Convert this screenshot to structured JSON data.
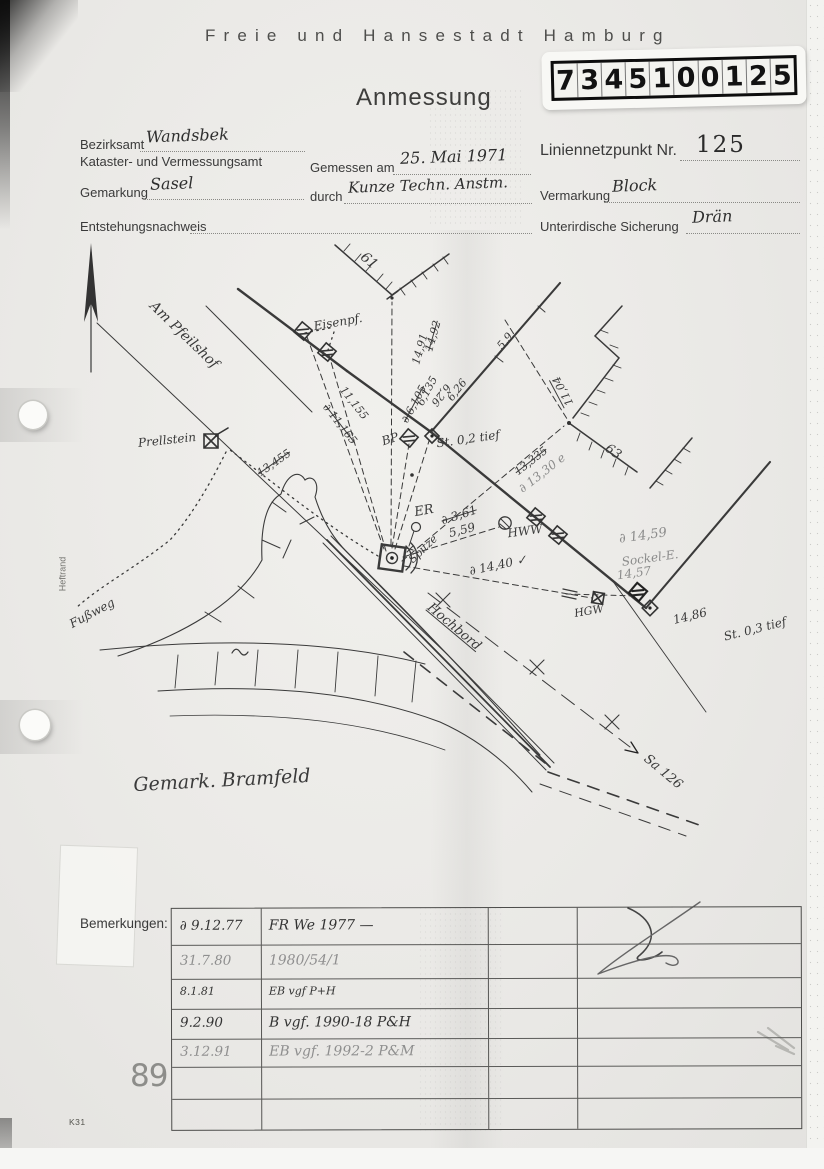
{
  "colors": {
    "paper": "#e9e8e5",
    "ink": "#333333",
    "pencil": "#8b8b8b"
  },
  "header": {
    "title": "Freie und Hansestadt Hamburg",
    "form_title": "Anmessung"
  },
  "id_label": {
    "digits": [
      "7",
      "3",
      "4",
      "5",
      "1",
      "0",
      "0",
      "1",
      "2",
      "5"
    ]
  },
  "form": {
    "bezirksamt_label": "Bezirksamt",
    "bezirksamt_value": "Wandsbek",
    "amt_label": "Kataster- und Vermessungsamt",
    "gemessen_label": "Gemessen am",
    "gemessen_value": "25. Mai 1971",
    "durch_label": "durch",
    "durch_value": "Kunze Techn. Anstm.",
    "punkt_label": "Liniennetzpunkt Nr.",
    "punkt_value": "125",
    "gemarkung_label": "Gemarkung",
    "gemarkung_value": "Sasel",
    "vermarkung_label": "Vermarkung",
    "vermarkung_value": "Block",
    "entstehung_label": "Entstehungsnachweis",
    "sicherung_label": "Unterirdische Sicherung",
    "sicherung_value": "Drän"
  },
  "sketch": {
    "labels": [
      {
        "t": "61",
        "x": 369,
        "y": 261,
        "r": 40,
        "s": 14
      },
      {
        "t": "Eisenpf.",
        "x": 338,
        "y": 322,
        "r": -10,
        "s": 12
      },
      {
        "t": "14,92",
        "x": 433,
        "y": 336,
        "r": -74,
        "s": 11,
        "c": "strike"
      },
      {
        "t": "14,91",
        "x": 420,
        "y": 349,
        "r": -74,
        "s": 11
      },
      {
        "t": "∂ 11,165",
        "x": 340,
        "y": 424,
        "r": 52,
        "s": 11,
        "c": "strike"
      },
      {
        "t": "11,155",
        "x": 354,
        "y": 403,
        "r": 52,
        "s": 11
      },
      {
        "t": "∂ 6,105",
        "x": 414,
        "y": 404,
        "r": -62,
        "s": 11,
        "c": "strike"
      },
      {
        "t": "6,135",
        "x": 427,
        "y": 391,
        "r": -62,
        "s": 11
      },
      {
        "t": "6,26",
        "x": 457,
        "y": 390,
        "r": -52,
        "s": 11
      },
      {
        "t": "6,26",
        "x": 441,
        "y": 395,
        "r": 128,
        "s": 11
      },
      {
        "t": "5,9",
        "x": 505,
        "y": 341,
        "r": -50,
        "s": 11
      },
      {
        "t": "11,04",
        "x": 563,
        "y": 391,
        "r": -118,
        "s": 11,
        "c": "over"
      },
      {
        "t": "63",
        "x": 613,
        "y": 452,
        "r": 35,
        "s": 13
      },
      {
        "t": "St. 0,2 tief",
        "x": 468,
        "y": 439,
        "r": -8,
        "s": 12
      },
      {
        "t": "BP",
        "x": 390,
        "y": 439,
        "r": -18,
        "s": 12
      },
      {
        "t": "13,335",
        "x": 531,
        "y": 461,
        "r": -38,
        "s": 11,
        "c": "strike"
      },
      {
        "t": "∂ 13,30 e",
        "x": 542,
        "y": 473,
        "r": -38,
        "s": 12,
        "c": "pencil"
      },
      {
        "t": "ER",
        "x": 424,
        "y": 511,
        "r": -10,
        "s": 13
      },
      {
        "t": "∂ 3,61",
        "x": 459,
        "y": 515,
        "r": -18,
        "s": 12,
        "c": "strike"
      },
      {
        "t": "5,59",
        "x": 462,
        "y": 530,
        "r": -14,
        "s": 12
      },
      {
        "t": "Spitze",
        "x": 423,
        "y": 549,
        "r": -44,
        "s": 11
      },
      {
        "t": "HWW",
        "x": 525,
        "y": 531,
        "r": -8,
        "s": 12
      },
      {
        "t": "∂ 14,40 ✓",
        "x": 498,
        "y": 565,
        "r": -12,
        "s": 12
      },
      {
        "t": "∂ 14,59",
        "x": 643,
        "y": 536,
        "r": -8,
        "s": 13,
        "c": "pencil"
      },
      {
        "t": "Sockel-E.",
        "x": 650,
        "y": 558,
        "r": -8,
        "s": 12,
        "c": "pencil"
      },
      {
        "t": "14,57",
        "x": 634,
        "y": 573,
        "r": -8,
        "s": 12,
        "c": "pencil"
      },
      {
        "t": "HGW",
        "x": 589,
        "y": 611,
        "r": -10,
        "s": 11
      },
      {
        "t": "14,86",
        "x": 690,
        "y": 616,
        "r": -14,
        "s": 12
      },
      {
        "t": "St. 0,3 tief",
        "x": 755,
        "y": 629,
        "r": -14,
        "s": 12
      },
      {
        "t": "Prellstein",
        "x": 167,
        "y": 440,
        "r": -6,
        "s": 12
      },
      {
        "t": "13,455",
        "x": 274,
        "y": 463,
        "r": -35,
        "s": 11,
        "c": "strike"
      },
      {
        "t": "Am Pfeilshof",
        "x": 184,
        "y": 335,
        "r": 44,
        "s": 14
      },
      {
        "t": "Fußweg",
        "x": 92,
        "y": 613,
        "r": -28,
        "s": 12
      },
      {
        "t": "Hochbord",
        "x": 454,
        "y": 627,
        "r": 40,
        "s": 13,
        "c": "underline"
      },
      {
        "t": "Gemark. Bramfeld",
        "x": 222,
        "y": 781,
        "r": -3,
        "s": 19
      },
      {
        "t": "Sa 126",
        "x": 663,
        "y": 772,
        "r": 40,
        "s": 13
      },
      {
        "t": "Heftrand",
        "x": 63,
        "y": 574,
        "r": -90,
        "s": 9,
        "c": "print"
      }
    ]
  },
  "remarks": {
    "label": "Bemerkungen:",
    "rows": [
      {
        "date": "∂ 9.12.77",
        "text": "FR We 1977 —",
        "style": "ink"
      },
      {
        "date": "31.7.80",
        "text": "1980/54/1",
        "style": "pencil"
      },
      {
        "date": "8.1.81",
        "text": "EB vgf P+H",
        "style": "ink-small"
      },
      {
        "date": "9.2.90",
        "text": "B vgf. 1990-18 P&H",
        "style": "ink"
      },
      {
        "date": "3.12.91",
        "text": "EB vgf. 1992-2 P&M",
        "style": "pencil"
      },
      {
        "date": "",
        "text": "",
        "style": "ink"
      },
      {
        "date": "",
        "text": "",
        "style": "ink"
      }
    ]
  },
  "footer": {
    "page_number": "89",
    "form_code": "K31"
  }
}
